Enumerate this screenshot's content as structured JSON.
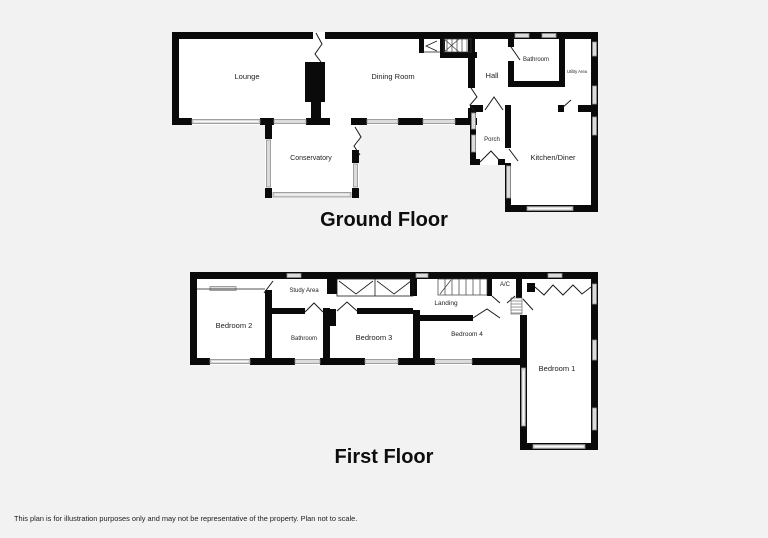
{
  "page": {
    "disclaimer": "This plan is for illustration purposes only and may not be representative of the property. Plan not to scale."
  },
  "colors": {
    "background": "#f2f2f2",
    "floor_fill": "#ffffff",
    "wall": "#0a0a0a",
    "window_fill": "#dcdcdc",
    "text": "#222222"
  },
  "ground_floor": {
    "title": "Ground Floor",
    "rooms": {
      "lounge": "Lounge",
      "dining_room": "Dining Room",
      "hall": "Hall",
      "bathroom": "Bathroom",
      "utility_area": "Utility Area",
      "porch": "Porch",
      "kitchen_diner": "Kitchen/Diner",
      "conservatory": "Conservatory"
    }
  },
  "first_floor": {
    "title": "First Floor",
    "rooms": {
      "bedroom_1": "Bedroom 1",
      "bedroom_2": "Bedroom 2",
      "bedroom_3": "Bedroom 3",
      "bedroom_4": "Bedroom 4",
      "bathroom": "Bathroom",
      "study_area": "Study Area",
      "landing": "Landing",
      "ac": "A/C"
    }
  }
}
